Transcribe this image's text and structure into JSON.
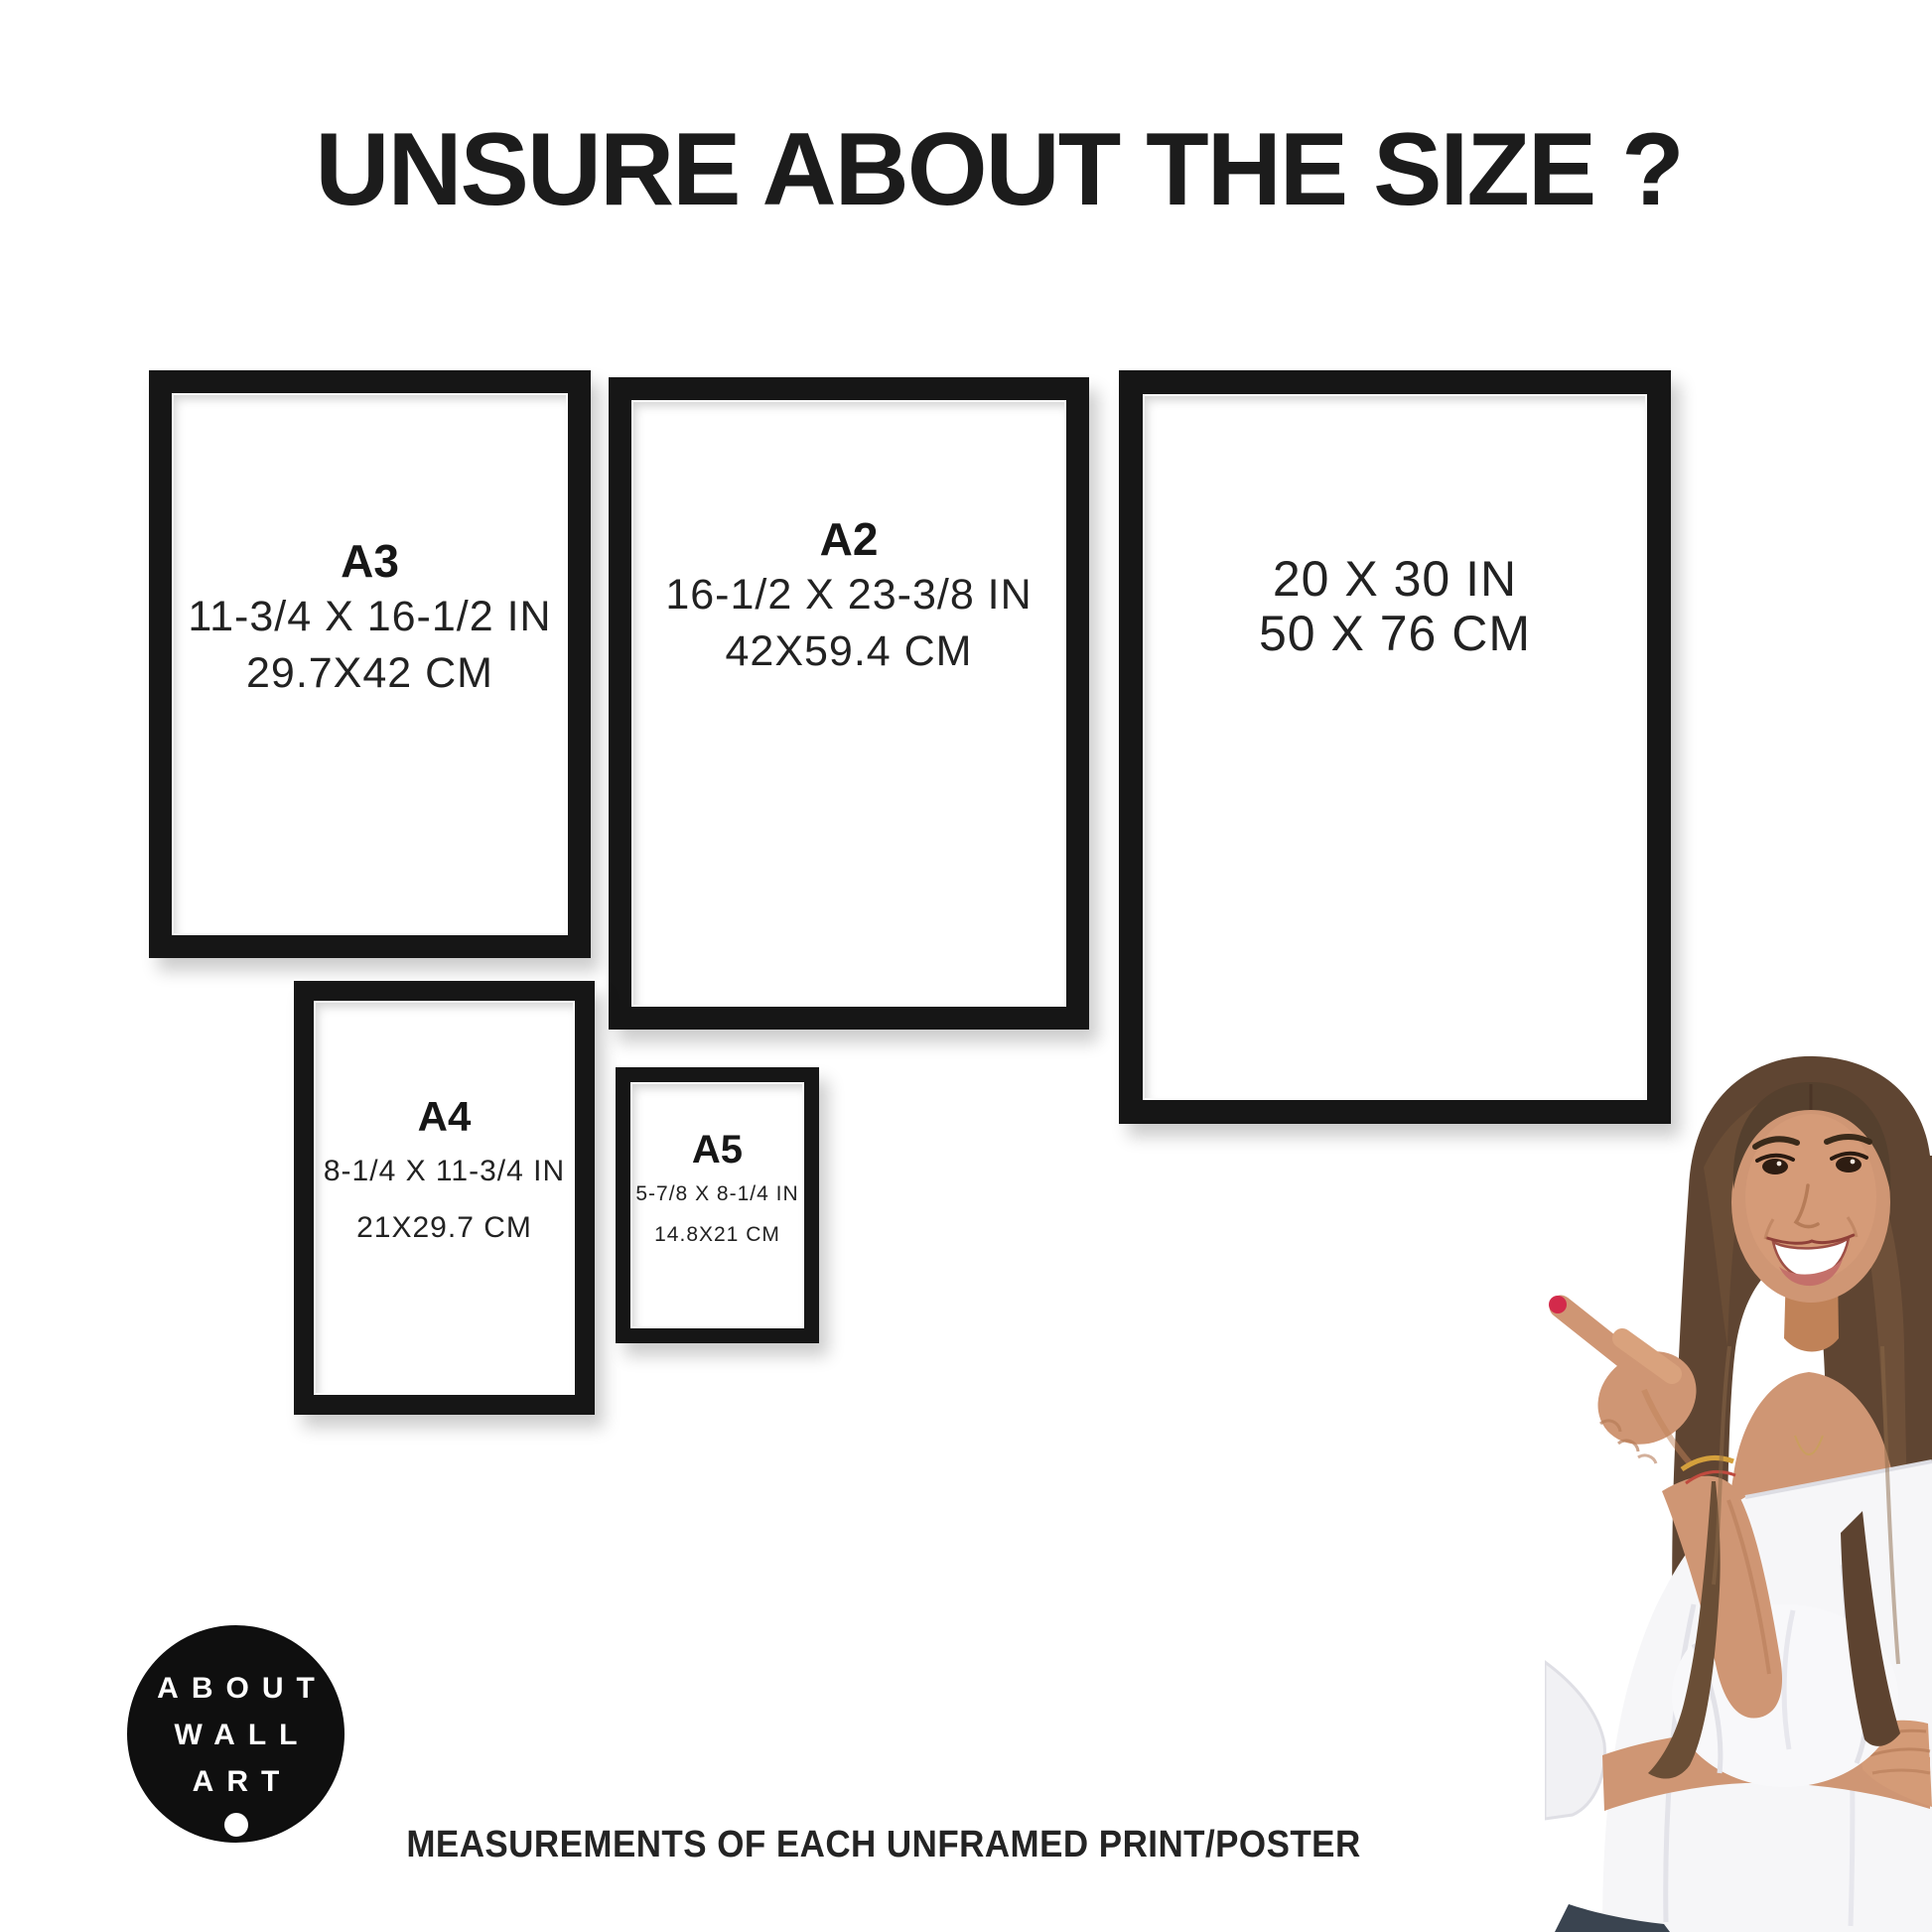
{
  "page": {
    "title": "UNSURE ABOUT THE SIZE ?",
    "caption": "MEASUREMENTS OF EACH UNFRAMED PRINT/POSTER"
  },
  "frames": {
    "a3": {
      "label": "A3",
      "inches": "11-3/4 X 16-1/2 IN",
      "cm": "29.7X42 CM"
    },
    "a2": {
      "label": "A2",
      "inches": "16-1/2 X 23-3/8 IN",
      "cm": "42X59.4 CM"
    },
    "p2030": {
      "inches": "20 X 30 IN",
      "cm": "50 X 76 CM"
    },
    "a4": {
      "label": "A4",
      "inches": "8-1/4 X 11-3/4 IN",
      "cm": "21X29.7 CM"
    },
    "a5": {
      "label": "A5",
      "inches": "5-7/8 X 8-1/4 IN",
      "cm": "14.8X21 CM"
    }
  },
  "logo": {
    "line1": "ABOUT",
    "line2": "WALL",
    "line3": "ART"
  },
  "colors": {
    "background": "#ffffff",
    "frame": "#161616",
    "text": "#1c1c1c",
    "logo_background": "#0f0f0f",
    "logo_text": "#ffffff",
    "skin": "#cf9674",
    "hair": "#5f4532",
    "blouse": "#f6f6f8",
    "nail_polish": "#d32a4b"
  }
}
